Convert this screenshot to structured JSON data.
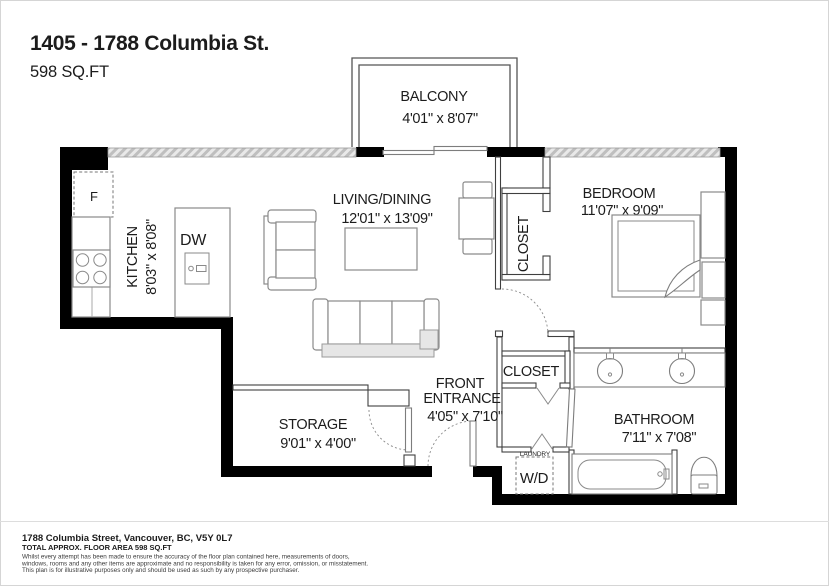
{
  "header": {
    "title": "1405 - 1788 Columbia St.",
    "area": "598 SQ.FT"
  },
  "rooms": {
    "balcony": {
      "name": "BALCONY",
      "dims": "4'01\" x 8'07\""
    },
    "kitchen": {
      "name": "KITCHEN",
      "dims": "8'03\" x 8'08\""
    },
    "living_dining": {
      "name": "LIVING/DINING",
      "dims": "12'01\" x 13'09\""
    },
    "bedroom": {
      "name": "BEDROOM",
      "dims": "11'07\" x 9'09\""
    },
    "bedroom_closet": {
      "name": "CLOSET"
    },
    "hall_closet": {
      "name": "CLOSET"
    },
    "front_entrance": {
      "name_line1": "FRONT",
      "name_line2": "ENTRANCE",
      "dims": "4'05\" x 7'10\""
    },
    "storage": {
      "name": "STORAGE",
      "dims": "9'01\" x 4'00\""
    },
    "bathroom": {
      "name": "BATHROOM",
      "dims": "7'11\" x 7'08\""
    },
    "laundry": {
      "name": "LAUNDRY",
      "appliance": "W/D"
    }
  },
  "appliances": {
    "fridge": "F",
    "dishwasher": "DW"
  },
  "footer": {
    "address": "1788 Columbia Street, Vancouver, BC, V5Y 0L7",
    "total_area": "TOTAL APPROX. FLOOR AREA  598 SQ.FT",
    "disclaimer_lines": [
      "Whilst every attempt has been made to ensure the accuracy of the floor plan contained here, measurements of doors,",
      "windows, rooms and any other items are approximate and no responsibility is taken for any error, omission, or misstatement.",
      "This plan is for illustrative purposes only and should be used as such by any prospective purchaser."
    ]
  },
  "colors": {
    "wall": "#000000",
    "interior_wall_line": "#3f3f3f",
    "fixture_line": "#8a8a8a",
    "window_fill": "#d6d6d6",
    "text": "#1c1c1c",
    "muted_text": "#3a3a3a"
  }
}
